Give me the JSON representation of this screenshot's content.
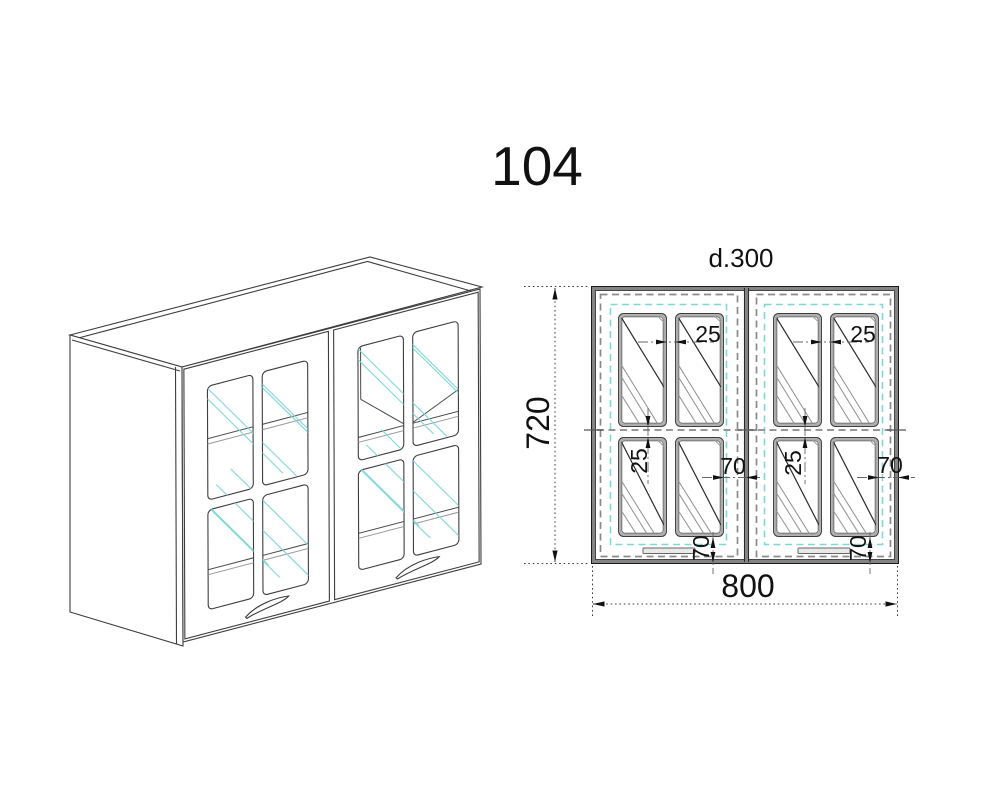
{
  "title": "104",
  "elevation": {
    "depth_label": "d.300",
    "height_mm": "720",
    "width_mm": "800",
    "pane_gap_mm": "25",
    "edge_offset_mm": "70"
  },
  "colors": {
    "line": "#3d3d3d",
    "dash_gray": "#8a8a8a",
    "glass_cyan": "#7fd8d8",
    "dim_text": "#111111"
  }
}
